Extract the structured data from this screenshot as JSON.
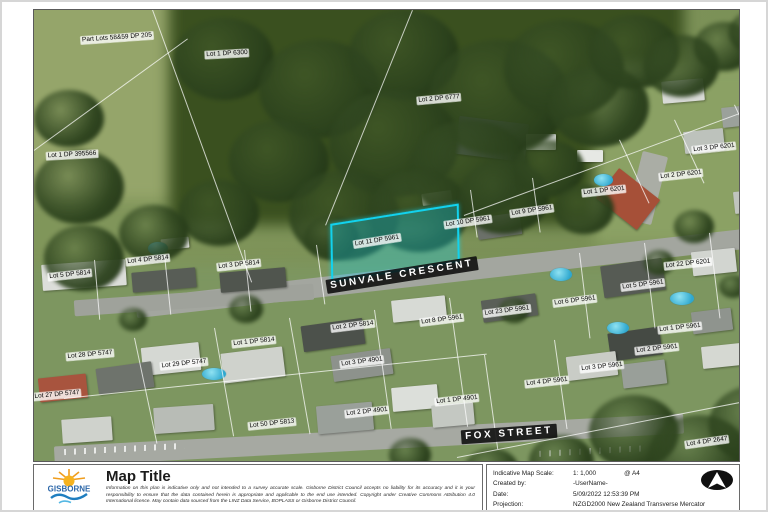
{
  "map": {
    "highlight": {
      "x": 296,
      "y": 204,
      "w": 126,
      "h": 54,
      "rot": -9
    },
    "parcel_labels": [
      {
        "text": "Part Lots 58&59 DP 205",
        "x": 83,
        "y": 28,
        "rot": -4
      },
      {
        "text": "Lot 1 DP 6300",
        "x": 193,
        "y": 44,
        "rot": -3
      },
      {
        "text": "Lot 2 DP 6777",
        "x": 405,
        "y": 89,
        "rot": -5
      },
      {
        "text": "Lot 1 DP 395566",
        "x": 38,
        "y": 145,
        "rot": -3
      },
      {
        "text": "Lot 3 DP 6201",
        "x": 680,
        "y": 138,
        "rot": -6
      },
      {
        "text": "Lot 2 DP 6201",
        "x": 647,
        "y": 165,
        "rot": -6
      },
      {
        "text": "Lot 1 DP 6201",
        "x": 570,
        "y": 181,
        "rot": -6
      },
      {
        "text": "Lot 9 DP 5961",
        "x": 498,
        "y": 201,
        "rot": -8
      },
      {
        "text": "Lot 10 DP 5961",
        "x": 434,
        "y": 212,
        "rot": -8
      },
      {
        "text": "Lot 11 DP 5961",
        "x": 343,
        "y": 231,
        "rot": -9
      },
      {
        "text": "Lot 22 DP 6201",
        "x": 654,
        "y": 254,
        "rot": -6
      },
      {
        "text": "Lot 4 DP 5814",
        "x": 114,
        "y": 250,
        "rot": -6
      },
      {
        "text": "Lot 3 DP 5814",
        "x": 205,
        "y": 255,
        "rot": -6
      },
      {
        "text": "Lot 5 DP 5814",
        "x": 36,
        "y": 265,
        "rot": -6
      },
      {
        "text": "Lot 5 DP 5961",
        "x": 609,
        "y": 275,
        "rot": -7
      },
      {
        "text": "Lot 6 DP 5961",
        "x": 541,
        "y": 291,
        "rot": -7
      },
      {
        "text": "Lot 23 DP 5961",
        "x": 473,
        "y": 301,
        "rot": -7
      },
      {
        "text": "Lot 8 DP 5961",
        "x": 408,
        "y": 310,
        "rot": -7
      },
      {
        "text": "Lot 2 DP 5814",
        "x": 319,
        "y": 316,
        "rot": -7
      },
      {
        "text": "Lot 1 DP 5961",
        "x": 646,
        "y": 318,
        "rot": -6
      },
      {
        "text": "Lot 1 DP 5814",
        "x": 220,
        "y": 332,
        "rot": -6
      },
      {
        "text": "Lot 2 DP 5961",
        "x": 623,
        "y": 339,
        "rot": -6
      },
      {
        "text": "Lot 28 DP 5747",
        "x": 56,
        "y": 345,
        "rot": -5
      },
      {
        "text": "Lot 29 DP 5747",
        "x": 150,
        "y": 354,
        "rot": -6
      },
      {
        "text": "Lot 3 DP 4901",
        "x": 328,
        "y": 352,
        "rot": -7
      },
      {
        "text": "Lot 3 DP 5961",
        "x": 568,
        "y": 357,
        "rot": -6
      },
      {
        "text": "Lot 4 DP 5961",
        "x": 513,
        "y": 372,
        "rot": -6
      },
      {
        "text": "Lot 27 DP 5747",
        "x": 23,
        "y": 385,
        "rot": -5
      },
      {
        "text": "Lot 1 DP 4901",
        "x": 423,
        "y": 390,
        "rot": -6
      },
      {
        "text": "Lot 2 DP 4901",
        "x": 333,
        "y": 402,
        "rot": -6
      },
      {
        "text": "Lot 50 DP 5813",
        "x": 238,
        "y": 414,
        "rot": -6
      },
      {
        "text": "Lot 4 DP 2647",
        "x": 673,
        "y": 432,
        "rot": -8
      }
    ],
    "street_labels": [
      {
        "text": "SUNVALE CRESCENT",
        "x": 368,
        "y": 265,
        "rot": -9
      },
      {
        "text": "FOX STREET",
        "x": 475,
        "y": 424,
        "rot": -4
      }
    ]
  },
  "scenery": {
    "patches": [
      {
        "x": -20,
        "y": -20,
        "w": 330,
        "h": 210,
        "c": "#95a56a"
      },
      {
        "x": 135,
        "y": -25,
        "w": 515,
        "h": 240,
        "c": "#3a501f"
      },
      {
        "x": 560,
        "y": 55,
        "w": 210,
        "h": 180,
        "c": "#8ba164"
      },
      {
        "x": -20,
        "y": 255,
        "w": 770,
        "h": 230,
        "c": "#7d9660"
      }
    ],
    "roads": [
      {
        "x": 100,
        "y": 252,
        "w": 640,
        "h": 20,
        "rot": -6.5,
        "c": "#a3a69f"
      },
      {
        "x": 40,
        "y": 282,
        "w": 240,
        "h": 16,
        "rot": -4,
        "c": "#9fa29b"
      },
      {
        "x": 20,
        "y": 420,
        "w": 630,
        "h": 20,
        "rot": -3,
        "c": "#a6a9a2"
      },
      {
        "x": 600,
        "y": 143,
        "w": 26,
        "h": 70,
        "rot": 14,
        "c": "#aaada5"
      }
    ],
    "markings": [
      {
        "x": 30,
        "y": 436,
        "w": 120,
        "h": 6,
        "rot": -3
      },
      {
        "x": 505,
        "y": 438,
        "w": 110,
        "h": 6,
        "rot": -3
      }
    ],
    "houses": [
      {
        "x": 423,
        "y": 110,
        "w": 70,
        "h": 38,
        "c": "#46524a",
        "rot": 7
      },
      {
        "x": 492,
        "y": 124,
        "w": 30,
        "h": 16,
        "c": "#ccd0ca",
        "rot": 0
      },
      {
        "x": 388,
        "y": 182,
        "w": 30,
        "h": 12,
        "c": "#dfe2dc",
        "rot": -8
      },
      {
        "x": 443,
        "y": 205,
        "w": 44,
        "h": 22,
        "c": "#6b7069",
        "rot": -8
      },
      {
        "x": 628,
        "y": 70,
        "w": 42,
        "h": 22,
        "c": "#d8dad6",
        "rot": -5
      },
      {
        "x": 688,
        "y": 96,
        "w": 38,
        "h": 20,
        "c": "#9ba19b",
        "rot": -6
      },
      {
        "x": 650,
        "y": 120,
        "w": 40,
        "h": 22,
        "c": "#bdc2bc",
        "rot": -6
      },
      {
        "x": 568,
        "y": 170,
        "w": 52,
        "h": 38,
        "c": "#a65038",
        "rot": 38
      },
      {
        "x": 543,
        "y": 140,
        "w": 26,
        "h": 12,
        "c": "#e6e8e4",
        "rot": 0
      },
      {
        "x": 700,
        "y": 180,
        "w": 40,
        "h": 22,
        "c": "#c0c4be",
        "rot": -6
      },
      {
        "x": 8,
        "y": 252,
        "w": 84,
        "h": 26,
        "c": "#dcdeda",
        "rot": -4
      },
      {
        "x": 98,
        "y": 260,
        "w": 64,
        "h": 20,
        "c": "#585d56",
        "rot": -5
      },
      {
        "x": 186,
        "y": 260,
        "w": 66,
        "h": 20,
        "c": "#50554e",
        "rot": -5
      },
      {
        "x": 127,
        "y": 228,
        "w": 28,
        "h": 11,
        "c": "#e2e4e0",
        "rot": -6
      },
      {
        "x": 108,
        "y": 335,
        "w": 58,
        "h": 28,
        "c": "#d5d8d3",
        "rot": -6
      },
      {
        "x": 63,
        "y": 355,
        "w": 56,
        "h": 26,
        "c": "#6e736c",
        "rot": -8
      },
      {
        "x": 5,
        "y": 366,
        "w": 48,
        "h": 24,
        "c": "#a8543e",
        "rot": -6
      },
      {
        "x": 188,
        "y": 340,
        "w": 62,
        "h": 30,
        "c": "#cfd2cc",
        "rot": -7
      },
      {
        "x": 268,
        "y": 312,
        "w": 62,
        "h": 26,
        "c": "#4c514b",
        "rot": -8
      },
      {
        "x": 298,
        "y": 342,
        "w": 60,
        "h": 26,
        "c": "#8d928c",
        "rot": -8
      },
      {
        "x": 358,
        "y": 288,
        "w": 54,
        "h": 22,
        "c": "#d7dad5",
        "rot": -6
      },
      {
        "x": 283,
        "y": 394,
        "w": 56,
        "h": 28,
        "c": "#9aa09a",
        "rot": -5
      },
      {
        "x": 358,
        "y": 376,
        "w": 46,
        "h": 24,
        "c": "#dcdfda",
        "rot": -5
      },
      {
        "x": 398,
        "y": 394,
        "w": 42,
        "h": 22,
        "c": "#c4c8c2",
        "rot": -5
      },
      {
        "x": 120,
        "y": 396,
        "w": 60,
        "h": 26,
        "c": "#b8bcb6",
        "rot": -4
      },
      {
        "x": 28,
        "y": 408,
        "w": 50,
        "h": 24,
        "c": "#cfd2cc",
        "rot": -4
      },
      {
        "x": 568,
        "y": 252,
        "w": 62,
        "h": 32,
        "c": "#565b54",
        "rot": -8
      },
      {
        "x": 658,
        "y": 240,
        "w": 44,
        "h": 24,
        "c": "#d2d5d0",
        "rot": -6
      },
      {
        "x": 575,
        "y": 320,
        "w": 52,
        "h": 28,
        "c": "#454a44",
        "rot": -8
      },
      {
        "x": 533,
        "y": 344,
        "w": 50,
        "h": 24,
        "c": "#c9ccc6",
        "rot": -7
      },
      {
        "x": 588,
        "y": 352,
        "w": 44,
        "h": 24,
        "c": "#999f99",
        "rot": -7
      },
      {
        "x": 658,
        "y": 300,
        "w": 40,
        "h": 22,
        "c": "#8f948e",
        "rot": -7
      },
      {
        "x": 668,
        "y": 335,
        "w": 40,
        "h": 22,
        "c": "#d5d8d2",
        "rot": -6
      },
      {
        "x": 448,
        "y": 287,
        "w": 55,
        "h": 22,
        "c": "#5a5f58",
        "rot": -8
      }
    ],
    "pools": [
      {
        "x": 114,
        "y": 232,
        "w": 20,
        "h": 13
      },
      {
        "x": 168,
        "y": 358,
        "w": 24,
        "h": 12
      },
      {
        "x": 560,
        "y": 164,
        "w": 19,
        "h": 12
      },
      {
        "x": 516,
        "y": 258,
        "w": 22,
        "h": 13
      },
      {
        "x": 636,
        "y": 282,
        "w": 24,
        "h": 13
      },
      {
        "x": 573,
        "y": 312,
        "w": 22,
        "h": 12
      }
    ],
    "trees": [
      {
        "x": 140,
        "y": 8,
        "d": 100
      },
      {
        "x": 225,
        "y": 30,
        "d": 120
      },
      {
        "x": 315,
        "y": 0,
        "d": 110
      },
      {
        "x": 395,
        "y": 30,
        "d": 140
      },
      {
        "x": 470,
        "y": 10,
        "d": 120
      },
      {
        "x": 295,
        "y": 80,
        "d": 130
      },
      {
        "x": 375,
        "y": 110,
        "d": 120
      },
      {
        "x": 195,
        "y": 110,
        "d": 100
      },
      {
        "x": 255,
        "y": 160,
        "d": 110
      },
      {
        "x": 335,
        "y": 160,
        "d": 100
      },
      {
        "x": 425,
        "y": 150,
        "d": 90
      },
      {
        "x": 145,
        "y": 170,
        "d": 80
      },
      {
        "x": 85,
        "y": 195,
        "d": 70
      },
      {
        "x": 515,
        "y": 55,
        "d": 100
      },
      {
        "x": 555,
        "y": 5,
        "d": 90
      },
      {
        "x": 610,
        "y": 25,
        "d": 75
      },
      {
        "x": 660,
        "y": 12,
        "d": 60
      },
      {
        "x": 695,
        "y": 0,
        "d": 55
      },
      {
        "x": 480,
        "y": 130,
        "d": 70
      },
      {
        "x": 520,
        "y": 175,
        "d": 60
      },
      {
        "x": 270,
        "y": 205,
        "d": 55
      },
      {
        "x": 0,
        "y": 140,
        "d": 90
      },
      {
        "x": 10,
        "y": 215,
        "d": 80
      },
      {
        "x": 0,
        "y": 80,
        "d": 70
      },
      {
        "x": 555,
        "y": 385,
        "d": 90
      },
      {
        "x": 615,
        "y": 405,
        "d": 100
      },
      {
        "x": 675,
        "y": 375,
        "d": 95
      },
      {
        "x": 715,
        "y": 415,
        "d": 85
      },
      {
        "x": 495,
        "y": 425,
        "d": 65
      },
      {
        "x": 430,
        "y": 438,
        "d": 55
      },
      {
        "x": 195,
        "y": 285,
        "d": 34
      },
      {
        "x": 465,
        "y": 288,
        "d": 30
      },
      {
        "x": 685,
        "y": 265,
        "d": 28
      },
      {
        "x": 355,
        "y": 428,
        "d": 42
      },
      {
        "x": 85,
        "y": 298,
        "d": 28
      },
      {
        "x": 640,
        "y": 200,
        "d": 40
      },
      {
        "x": 610,
        "y": 240,
        "d": 30
      }
    ],
    "lines": [
      {
        "x": 118,
        "y": 0,
        "len": 290,
        "rot": -20
      },
      {
        "x": 378,
        "y": 0,
        "len": 232,
        "rot": 22
      },
      {
        "x": 430,
        "y": 205,
        "len": 332,
        "rot": -20.3,
        "h": 1
      },
      {
        "x": 423,
        "y": 447,
        "len": 316,
        "rot": -11,
        "h": 1
      },
      {
        "x": 30,
        "y": 388,
        "len": 425,
        "rot": -6,
        "h": 1
      },
      {
        "x": 0,
        "y": 140,
        "len": 190,
        "rot": -36,
        "h": 1
      },
      {
        "x": 436,
        "y": 180,
        "len": 48,
        "rot": -8
      },
      {
        "x": 498,
        "y": 168,
        "len": 55,
        "rot": -8
      },
      {
        "x": 340,
        "y": 300,
        "len": 120,
        "rot": -8
      },
      {
        "x": 415,
        "y": 288,
        "len": 130,
        "rot": -8
      },
      {
        "x": 255,
        "y": 308,
        "len": 118,
        "rot": -10
      },
      {
        "x": 180,
        "y": 318,
        "len": 110,
        "rot": -10
      },
      {
        "x": 100,
        "y": 328,
        "len": 108,
        "rot": -12
      },
      {
        "x": 545,
        "y": 243,
        "len": 86,
        "rot": -7
      },
      {
        "x": 610,
        "y": 233,
        "len": 86,
        "rot": -7
      },
      {
        "x": 675,
        "y": 223,
        "len": 86,
        "rot": -7
      },
      {
        "x": 520,
        "y": 330,
        "len": 90,
        "rot": -8
      },
      {
        "x": 450,
        "y": 345,
        "len": 95,
        "rot": -8
      },
      {
        "x": 585,
        "y": 130,
        "len": 70,
        "rot": -25
      },
      {
        "x": 640,
        "y": 110,
        "len": 70,
        "rot": -25
      },
      {
        "x": 700,
        "y": 95,
        "len": 70,
        "rot": -25
      },
      {
        "x": 60,
        "y": 250,
        "len": 60,
        "rot": -5
      },
      {
        "x": 130,
        "y": 245,
        "len": 60,
        "rot": -6
      },
      {
        "x": 210,
        "y": 240,
        "len": 62,
        "rot": -6
      },
      {
        "x": 282,
        "y": 235,
        "len": 60,
        "rot": -8
      }
    ]
  },
  "footer": {
    "logo": {
      "name": "Gisborne District Council",
      "text": "GISBORNE"
    },
    "title": "Map Title",
    "disclaimer": "Information on this plan is indicative only and not intended to a survey accurate scale. Gisborne District Council accepts no liability for its accuracy and it is your responsibility to ensure that the data contained herein is appropriate and applicable to the end use intended. Copyright under Creative Commons Attribution 4.0 International licence. May contain data sourced from the LINZ Data Service, BOPLASS or Gisborne District Council.",
    "info": {
      "scale_label": "Indicative Map Scale:",
      "scale_value": "1: 1,000",
      "page_size": "@ A4",
      "created_label": "Created by:",
      "created_value": "-UserName-",
      "date_label": "Date:",
      "date_value": "5/09/2022 12:53:39 PM",
      "projection_label": "Projection:",
      "projection_value": "NZGD2000 New Zealand Transverse Mercator"
    }
  }
}
